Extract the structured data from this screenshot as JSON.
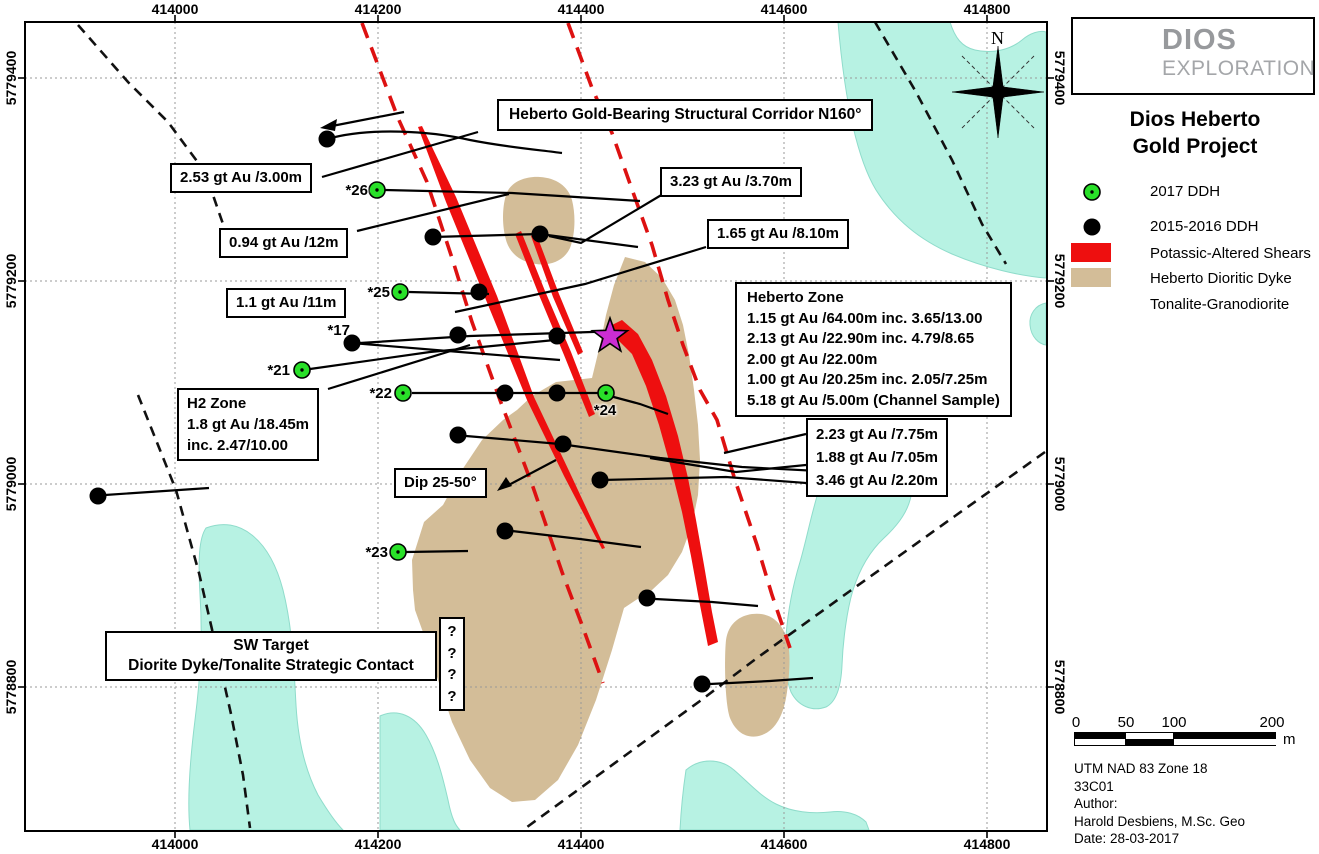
{
  "map": {
    "corridor_label": "Heberto Gold-Bearing Structural Corridor N160°",
    "north": "N",
    "annotations": {
      "a253": "2.53 gt Au /3.00m",
      "a094": "0.94 gt Au /12m",
      "a323": "3.23 gt Au /3.70m",
      "a165": "1.65 gt Au /8.10m",
      "a11": "1.1 gt Au /11m",
      "heberto_zone": "Heberto Zone\n1.15 gt Au /64.00m inc. 3.65/13.00\n2.13 gt Au /22.90m inc. 4.79/8.65\n2.00 gt Au /22.00m\n1.00 gt Au /20.25m inc. 2.05/7.25m\n5.18 gt Au /5.00m (Channel Sample)",
      "h2_zone": "H2 Zone\n1.8 gt Au /18.45m\ninc. 2.47/10.00",
      "a223": "2.23 gt Au /7.75m\n1.88 gt Au /7.05m\n3.46 gt Au /2.20m",
      "dip": "Dip 25-50°",
      "sw_target": "SW Target\nDiorite Dyke/Tonalite Strategic Contact",
      "q_marks": "?\n?\n?\n?"
    },
    "drillhole_labels": {
      "h26": "*26",
      "h25": "*25",
      "h17": "*17",
      "h21": "*21",
      "h22": "*22",
      "h24": "*24",
      "h23": "*23"
    },
    "axis": {
      "top": [
        "414000",
        "414200",
        "414400",
        "414600",
        "414800"
      ],
      "left": [
        "5779400",
        "5779200",
        "5779000",
        "5778800"
      ]
    }
  },
  "legend": {
    "logo": {
      "name": "DIOS",
      "sub": "EXPLORATION"
    },
    "title": "Dios Heberto\nGold Project",
    "items": [
      {
        "label": "2017 DDH"
      },
      {
        "label": "2015-2016 DDH"
      },
      {
        "label": "Potassic-Altered Shears"
      },
      {
        "label": "Heberto Dioritic Dyke"
      },
      {
        "label": "Tonalite-Granodiorite"
      }
    ],
    "scalebar": {
      "ticks": [
        "0",
        "50",
        "100",
        "200"
      ],
      "unit": "m"
    },
    "credits": "UTM NAD 83 Zone 18\n33C01\nAuthor:\nHarold Desbiens, M.Sc. Geo\nDate: 28-03-2017"
  },
  "colors": {
    "shear_red": "#ee0f0f",
    "dyke_tan": "#d3bd98",
    "water_cyan": "#b7f2e3",
    "ddh_2017_green": "#29e029",
    "discovery_star_magenta": "#cb2dd3"
  }
}
